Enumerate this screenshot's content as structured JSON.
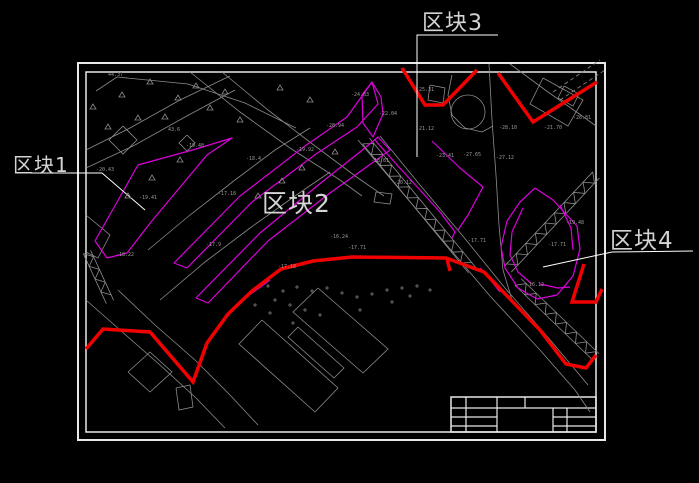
{
  "labels": {
    "block1": "区块1",
    "block2": "区块2",
    "block3": "区块3",
    "block4": "区块4"
  },
  "colors": {
    "background": "#000000",
    "frame": "#e8e8e8",
    "leader": "#ffffff",
    "red_boundary": "#f20000",
    "parcel_magenta": "#dd00dd",
    "base_gray": "#8c8c8c",
    "label_gray": "#d4d4d4",
    "spot_gray": "#9a9a9a"
  },
  "drawing": {
    "frame": {
      "outer": [
        78,
        63,
        527,
        377
      ],
      "inner": [
        86,
        72,
        510,
        360
      ]
    },
    "title_block": {
      "rect": [
        451,
        397,
        145,
        35
      ],
      "h_lines": [
        [
          451,
          408,
          596
        ],
        [
          451,
          417,
          497
        ],
        [
          553,
          417,
          596
        ],
        [
          451,
          426,
          497
        ],
        [
          553,
          426,
          596
        ]
      ],
      "v_lines": [
        [
          466,
          397,
          432
        ],
        [
          497,
          397,
          432
        ],
        [
          525,
          397,
          408
        ],
        [
          553,
          408,
          432
        ],
        [
          567,
          408,
          432
        ]
      ]
    },
    "leaders": [
      [
        [
          17,
          173
        ],
        [
          102,
          173
        ],
        [
          145,
          210
        ]
      ],
      [
        [
          498,
          35
        ],
        [
          417,
          35
        ],
        [
          417,
          157
        ]
      ],
      [
        [
          693,
          251
        ],
        [
          612,
          252
        ],
        [
          543,
          267
        ]
      ]
    ],
    "red_polylines": [
      [
        [
          86,
          349
        ],
        [
          103,
          329
        ],
        [
          150,
          332
        ],
        [
          193,
          382
        ],
        [
          207,
          343
        ],
        [
          228,
          314
        ],
        [
          252,
          291
        ],
        [
          281,
          269
        ],
        [
          313,
          261
        ],
        [
          352,
          257
        ],
        [
          446,
          258
        ],
        [
          484,
          272
        ],
        [
          540,
          330
        ],
        [
          566,
          364
        ],
        [
          586,
          368
        ],
        [
          596,
          355
        ]
      ],
      [
        [
          447,
          259
        ],
        [
          450,
          271
        ]
      ],
      [
        [
          402,
          68
        ],
        [
          425,
          105
        ],
        [
          443,
          105
        ],
        [
          477,
          70
        ]
      ],
      [
        [
          498,
          73
        ],
        [
          533,
          122
        ],
        [
          597,
          82
        ]
      ],
      [
        [
          584,
          264
        ],
        [
          572,
          302
        ],
        [
          596,
          302
        ],
        [
          602,
          289
        ]
      ]
    ],
    "magenta_polylines": [
      [
        [
          95,
          241
        ],
        [
          138,
          165
        ],
        [
          196,
          149
        ],
        [
          232,
          138
        ],
        [
          207,
          155
        ],
        [
          151,
          222
        ],
        [
          127,
          253
        ],
        [
          107,
          258
        ],
        [
          95,
          241
        ]
      ],
      [
        [
          174,
          263
        ],
        [
          240,
          196
        ],
        [
          305,
          146
        ],
        [
          347,
          117
        ],
        [
          372,
          82
        ],
        [
          378,
          104
        ],
        [
          357,
          127
        ],
        [
          316,
          154
        ],
        [
          252,
          202
        ],
        [
          187,
          268
        ],
        [
          174,
          263
        ]
      ],
      [
        [
          196,
          298
        ],
        [
          260,
          233
        ],
        [
          322,
          182
        ],
        [
          360,
          152
        ],
        [
          378,
          137
        ],
        [
          390,
          150
        ],
        [
          368,
          166
        ],
        [
          330,
          193
        ],
        [
          268,
          241
        ],
        [
          208,
          303
        ],
        [
          196,
          298
        ]
      ],
      [
        [
          372,
          82
        ],
        [
          362,
          95
        ],
        [
          363,
          123
        ],
        [
          373,
          137
        ],
        [
          383,
          114
        ],
        [
          381,
          97
        ],
        [
          372,
          82
        ]
      ],
      [
        [
          375,
          140
        ],
        [
          398,
          166
        ],
        [
          420,
          190
        ],
        [
          440,
          212
        ],
        [
          455,
          232
        ],
        [
          452,
          238
        ]
      ],
      [
        [
          432,
          141
        ],
        [
          460,
          168
        ],
        [
          483,
          187
        ],
        [
          468,
          215
        ],
        [
          458,
          230
        ]
      ],
      [
        [
          535,
          188
        ],
        [
          553,
          200
        ],
        [
          577,
          226
        ],
        [
          580,
          249
        ],
        [
          573,
          276
        ],
        [
          557,
          295
        ],
        [
          537,
          299
        ],
        [
          518,
          288
        ],
        [
          505,
          268
        ],
        [
          501,
          247
        ],
        [
          507,
          221
        ],
        [
          520,
          202
        ],
        [
          535,
          188
        ]
      ],
      [
        [
          523,
          208
        ],
        [
          512,
          232
        ],
        [
          510,
          255
        ],
        [
          518,
          272
        ],
        [
          532,
          284
        ]
      ],
      [
        [
          560,
          205
        ],
        [
          571,
          228
        ],
        [
          573,
          250
        ]
      ],
      [
        [
          248,
          296
        ],
        [
          270,
          280
        ]
      ],
      [
        [
          480,
          268
        ],
        [
          492,
          282
        ],
        [
          500,
          292
        ]
      ],
      [
        [
          540,
          284
        ],
        [
          558,
          288
        ],
        [
          570,
          287
        ]
      ]
    ],
    "gray_polylines": [
      [
        [
          96,
          91
        ],
        [
          117,
          77
        ],
        [
          188,
          84
        ],
        [
          245,
          103
        ],
        [
          296,
          128
        ]
      ],
      [
        [
          358,
          140
        ],
        [
          400,
          190
        ],
        [
          445,
          243
        ],
        [
          490,
          296
        ],
        [
          540,
          350
        ],
        [
          575,
          390
        ],
        [
          590,
          412
        ]
      ],
      [
        [
          380,
          136
        ],
        [
          420,
          185
        ],
        [
          462,
          235
        ],
        [
          505,
          288
        ],
        [
          552,
          342
        ],
        [
          588,
          385
        ]
      ],
      [
        [
          190,
          72
        ],
        [
          240,
          112
        ],
        [
          290,
          148
        ],
        [
          340,
          180
        ],
        [
          362,
          196
        ]
      ],
      [
        [
          222,
          72
        ],
        [
          268,
          110
        ],
        [
          315,
          146
        ],
        [
          358,
          178
        ],
        [
          384,
          196
        ]
      ],
      [
        [
          86,
          150
        ],
        [
          130,
          128
        ],
        [
          180,
          100
        ],
        [
          230,
          76
        ]
      ],
      [
        [
          86,
          168
        ],
        [
          135,
          145
        ],
        [
          185,
          117
        ],
        [
          235,
          90
        ]
      ],
      [
        [
          86,
          300
        ],
        [
          120,
          330
        ],
        [
          160,
          365
        ],
        [
          196,
          398
        ],
        [
          225,
          428
        ]
      ],
      [
        [
          118,
          290
        ],
        [
          155,
          325
        ],
        [
          195,
          360
        ],
        [
          230,
          395
        ],
        [
          258,
          425
        ]
      ],
      [
        [
          489,
          64
        ],
        [
          492,
          120
        ],
        [
          496,
          175
        ],
        [
          499,
          225
        ],
        [
          503,
          270
        ],
        [
          512,
          300
        ]
      ],
      [
        [
          452,
          75
        ],
        [
          448,
          95
        ],
        [
          452,
          115
        ],
        [
          465,
          128
        ],
        [
          482,
          132
        ],
        [
          493,
          126
        ]
      ],
      [
        [
          510,
          64
        ],
        [
          548,
          92
        ],
        [
          585,
          118
        ],
        [
          596,
          126
        ]
      ],
      [
        [
          543,
          78
        ],
        [
          583,
          100
        ],
        [
          568,
          126
        ],
        [
          530,
          104
        ],
        [
          543,
          78
        ]
      ],
      [
        [
          148,
          250
        ],
        [
          190,
          215
        ],
        [
          235,
          180
        ],
        [
          275,
          150
        ],
        [
          310,
          128
        ]
      ],
      [
        [
          160,
          300
        ],
        [
          205,
          262
        ],
        [
          250,
          228
        ],
        [
          295,
          196
        ],
        [
          330,
          172
        ]
      ],
      [
        [
          86,
          215
        ],
        [
          110,
          235
        ],
        [
          98,
          258
        ],
        [
          86,
          252
        ]
      ],
      [
        [
          128,
          372
        ],
        [
          150,
          352
        ],
        [
          172,
          372
        ],
        [
          150,
          392
        ],
        [
          128,
          372
        ]
      ],
      [
        [
          123,
          126
        ],
        [
          137,
          140
        ],
        [
          123,
          154
        ],
        [
          109,
          140
        ],
        [
          123,
          126
        ]
      ],
      [
        [
          187,
          135
        ],
        [
          195,
          143
        ],
        [
          187,
          151
        ],
        [
          179,
          143
        ],
        [
          187,
          135
        ]
      ],
      [
        [
          318,
          288
        ],
        [
          388,
          349
        ],
        [
          363,
          373
        ],
        [
          293,
          312
        ],
        [
          318,
          288
        ]
      ],
      [
        [
          298,
          327
        ],
        [
          344,
          368
        ],
        [
          334,
          378
        ],
        [
          288,
          337
        ],
        [
          298,
          327
        ]
      ],
      [
        [
          262,
          320
        ],
        [
          338,
          388
        ],
        [
          315,
          412
        ],
        [
          239,
          344
        ],
        [
          262,
          320
        ]
      ],
      [
        [
          176,
          388
        ],
        [
          190,
          385
        ],
        [
          193,
          407
        ],
        [
          179,
          410
        ],
        [
          176,
          388
        ]
      ],
      [
        [
          376,
          192
        ],
        [
          392,
          194
        ],
        [
          390,
          204
        ],
        [
          374,
          202
        ],
        [
          376,
          192
        ]
      ],
      [
        [
          430,
          85
        ],
        [
          445,
          88
        ],
        [
          443,
          103
        ],
        [
          428,
          100
        ],
        [
          430,
          85
        ]
      ],
      [
        [
          564,
          86
        ],
        [
          579,
          94
        ],
        [
          573,
          106
        ],
        [
          558,
          98
        ],
        [
          564,
          86
        ]
      ]
    ],
    "circles": [
      {
        "cx": 468,
        "cy": 112,
        "r": 17
      }
    ],
    "hatch_strips": [
      {
        "p1": [
          366,
          141
        ],
        "p2": [
          472,
          270
        ],
        "w": 9
      },
      {
        "p1": [
          596,
          175
        ],
        "p2": [
          508,
          269
        ],
        "w": 9
      },
      {
        "p1": [
          518,
          282
        ],
        "p2": [
          596,
          357
        ],
        "w": 9
      },
      {
        "p1": [
          87,
          252
        ],
        "p2": [
          110,
          302
        ],
        "w": 8
      }
    ],
    "dashed_lines": [
      [
        [
          553,
          92
        ],
        [
          600,
          60
        ]
      ],
      [
        [
          560,
          100
        ],
        [
          605,
          70
        ]
      ]
    ],
    "triangles": [
      [
        93,
        107
      ],
      [
        122,
        95
      ],
      [
        150,
        82
      ],
      [
        178,
        98
      ],
      [
        138,
        118
      ],
      [
        108,
        127
      ],
      [
        165,
        117
      ],
      [
        210,
        108
      ],
      [
        240,
        120
      ],
      [
        196,
        86
      ],
      [
        225,
        92
      ],
      [
        152,
        178
      ],
      [
        128,
        196
      ],
      [
        180,
        160
      ],
      [
        335,
        152
      ],
      [
        302,
        168
      ],
      [
        282,
        181
      ],
      [
        258,
        196
      ],
      [
        310,
        100
      ],
      [
        280,
        88
      ]
    ],
    "crosses": [
      [
        268,
        286
      ],
      [
        283,
        291
      ],
      [
        297,
        287
      ],
      [
        312,
        291
      ],
      [
        327,
        288
      ],
      [
        342,
        293
      ],
      [
        357,
        297
      ],
      [
        372,
        294
      ],
      [
        387,
        290
      ],
      [
        402,
        288
      ],
      [
        417,
        286
      ],
      [
        430,
        290
      ],
      [
        275,
        300
      ],
      [
        290,
        305
      ],
      [
        305,
        310
      ],
      [
        320,
        315
      ],
      [
        293,
        323
      ],
      [
        270,
        313
      ],
      [
        255,
        305
      ],
      [
        360,
        310
      ],
      [
        392,
        302
      ],
      [
        410,
        296
      ]
    ],
    "spot_labels": [
      [
        108,
        76,
        "44.37"
      ],
      [
        96,
        171,
        "-20.43"
      ],
      [
        139,
        199,
        "-19.41"
      ],
      [
        116,
        256,
        "-18.22"
      ],
      [
        186,
        147,
        "-19.48"
      ],
      [
        218,
        195,
        "-17.18"
      ],
      [
        278,
        268,
        "-17.18"
      ],
      [
        348,
        249,
        "-17.71"
      ],
      [
        371,
        162,
        "-18.81"
      ],
      [
        394,
        184,
        "-20.12"
      ],
      [
        416,
        130,
        "-21.12"
      ],
      [
        379,
        115,
        "-22.04"
      ],
      [
        436,
        157,
        "-23.41"
      ],
      [
        499,
        129,
        "-28.10"
      ],
      [
        544,
        129,
        "-21.70"
      ],
      [
        496,
        159,
        "-27.12"
      ],
      [
        468,
        242,
        "-17.71"
      ],
      [
        548,
        246,
        "-17.71"
      ],
      [
        566,
        224,
        "-19.48"
      ],
      [
        526,
        286,
        "-16.12"
      ],
      [
        416,
        91,
        "-25.31"
      ],
      [
        351,
        96,
        "-24.83"
      ],
      [
        326,
        127,
        "-20.94"
      ],
      [
        296,
        151,
        "-19.92"
      ],
      [
        573,
        119,
        "-26.81"
      ],
      [
        463,
        156,
        "-27.65"
      ],
      [
        168,
        131,
        "43.6"
      ],
      [
        330,
        238,
        "-16.24"
      ],
      [
        246,
        160,
        "-18.4"
      ],
      [
        206,
        246,
        "-17.9"
      ]
    ]
  }
}
